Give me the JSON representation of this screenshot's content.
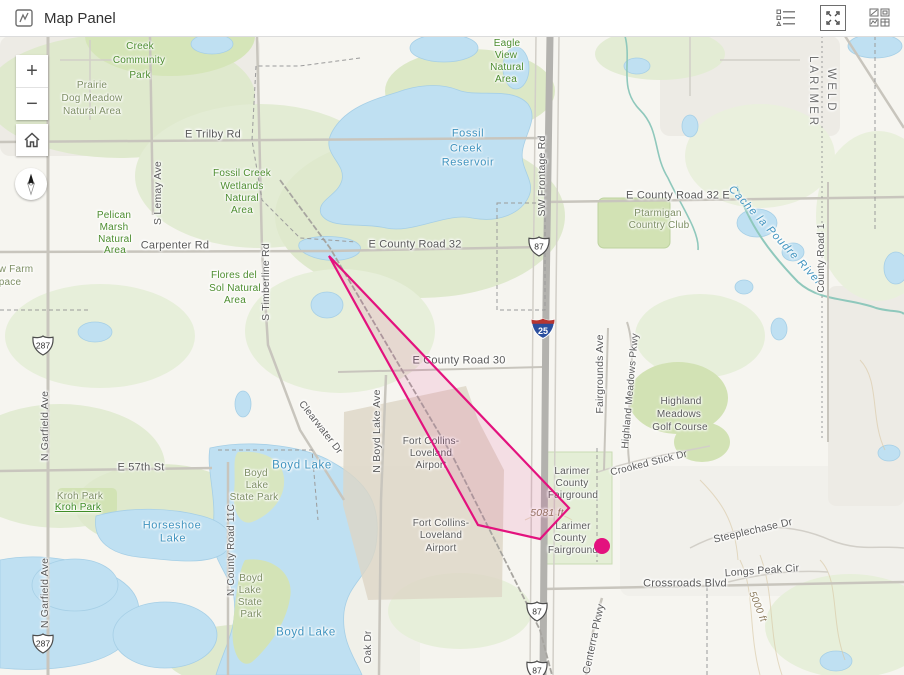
{
  "header": {
    "title": "Map Panel",
    "icons": {
      "left": "map-panel-icon",
      "right": [
        "legend-icon",
        "expand-icon",
        "grid-icon"
      ]
    }
  },
  "controls": {
    "zoom_in": "+",
    "zoom_out": "−",
    "home": "home-icon",
    "compass": "compass-north-icon"
  },
  "colors": {
    "accent_magenta": "#e3127e",
    "water_fill": "#bfe0f2",
    "veg_green": "#dfe9cd",
    "highway_gray": "#b3b2ae"
  },
  "map": {
    "overlay": {
      "polygon": {
        "points": [
          [
            329,
            220
          ],
          [
            569,
            472
          ],
          [
            540,
            503
          ],
          [
            478,
            489
          ]
        ],
        "stroke": "#e3127e",
        "fill": "rgba(227,18,126,0.10)"
      },
      "point": {
        "x": 602,
        "y": 510,
        "r": 8,
        "color": "#e3127e"
      }
    },
    "shields": [
      {
        "t": "287",
        "k": "us",
        "x": 43,
        "y": 312
      },
      {
        "t": "287",
        "k": "us",
        "x": 43,
        "y": 610
      },
      {
        "t": "87",
        "k": "us",
        "x": 539,
        "y": 213
      },
      {
        "t": "87",
        "k": "us",
        "x": 537,
        "y": 578
      },
      {
        "t": "87",
        "k": "us",
        "x": 537,
        "y": 637
      },
      {
        "t": "25",
        "k": "i",
        "x": 543,
        "y": 295
      }
    ],
    "labels": [
      {
        "t": "Creek",
        "x": 140,
        "y": 11,
        "c": "park"
      },
      {
        "t": "Community",
        "x": 139,
        "y": 25,
        "c": "park"
      },
      {
        "t": "Park",
        "x": 140,
        "y": 40,
        "c": "park"
      },
      {
        "t": "Eagle",
        "x": 507,
        "y": 8,
        "c": "park"
      },
      {
        "t": "View",
        "x": 506,
        "y": 20,
        "c": "park"
      },
      {
        "t": "Natural",
        "x": 507,
        "y": 32,
        "c": "park"
      },
      {
        "t": "Area",
        "x": 506,
        "y": 44,
        "c": "park"
      },
      {
        "t": "Fossil Creek",
        "x": 242,
        "y": 138,
        "c": "park"
      },
      {
        "t": "Wetlands",
        "x": 242,
        "y": 151,
        "c": "park"
      },
      {
        "t": "Natural",
        "x": 242,
        "y": 163,
        "c": "park"
      },
      {
        "t": "Area",
        "x": 242,
        "y": 175,
        "c": "park"
      },
      {
        "t": "Pelican",
        "x": 114,
        "y": 180,
        "c": "park"
      },
      {
        "t": "Marsh",
        "x": 114,
        "y": 192,
        "c": "park"
      },
      {
        "t": "Natural",
        "x": 115,
        "y": 204,
        "c": "park"
      },
      {
        "t": "Area",
        "x": 115,
        "y": 215,
        "c": "park"
      },
      {
        "t": "Flores del",
        "x": 234,
        "y": 240,
        "c": "park"
      },
      {
        "t": "Sol Natural",
        "x": 235,
        "y": 253,
        "c": "park"
      },
      {
        "t": "Area",
        "x": 235,
        "y": 265,
        "c": "park"
      },
      {
        "t": "Prairie",
        "x": 92,
        "y": 50,
        "c": "natural"
      },
      {
        "t": "Dog Meadow",
        "x": 92,
        "y": 63,
        "c": "natural"
      },
      {
        "t": "Natural Area",
        "x": 92,
        "y": 76,
        "c": "natural"
      },
      {
        "t": "w Farm",
        "x": 16,
        "y": 234,
        "c": "natural"
      },
      {
        "t": "pace",
        "x": 10,
        "y": 247,
        "c": "natural"
      },
      {
        "t": "Ptarmigan",
        "x": 658,
        "y": 178,
        "c": "natural"
      },
      {
        "t": "Country Club",
        "x": 659,
        "y": 190,
        "c": "natural"
      },
      {
        "t": "Kroh Park",
        "x": 80,
        "y": 461,
        "c": "natural"
      },
      {
        "t": "Kroh Park",
        "x": 78,
        "y": 472,
        "c": "link"
      },
      {
        "t": "Boyd",
        "x": 256,
        "y": 438,
        "c": "natural"
      },
      {
        "t": "Lake",
        "x": 257,
        "y": 450,
        "c": "natural"
      },
      {
        "t": "State Park",
        "x": 254,
        "y": 462,
        "c": "natural"
      },
      {
        "t": "Boyd",
        "x": 251,
        "y": 543,
        "c": "natural"
      },
      {
        "t": "Lake",
        "x": 250,
        "y": 555,
        "c": "natural"
      },
      {
        "t": "State",
        "x": 250,
        "y": 567,
        "c": "natural"
      },
      {
        "t": "Park",
        "x": 251,
        "y": 579,
        "c": "natural"
      },
      {
        "t": "Fossil",
        "x": 468,
        "y": 98,
        "c": "water",
        "s": 11
      },
      {
        "t": "Creek",
        "x": 466,
        "y": 113,
        "c": "water",
        "s": 11
      },
      {
        "t": "Reservoir",
        "x": 468,
        "y": 127,
        "c": "water",
        "s": 11
      },
      {
        "t": "Horseshoe",
        "x": 172,
        "y": 490,
        "c": "water",
        "s": 11
      },
      {
        "t": "Lake",
        "x": 173,
        "y": 503,
        "c": "water",
        "s": 11
      },
      {
        "t": "Boyd Lake",
        "x": 302,
        "y": 430,
        "c": "water",
        "s": 11.5
      },
      {
        "t": "Boyd Lake",
        "x": 306,
        "y": 597,
        "c": "water",
        "s": 11.5
      },
      {
        "t": "Cache la Poudre River",
        "x": 775,
        "y": 200,
        "c": "river",
        "s": 11,
        "r": 47
      },
      {
        "t": "E Trilby Rd",
        "x": 213,
        "y": 99,
        "c": "road",
        "s": 11
      },
      {
        "t": "Carpenter Rd",
        "x": 175,
        "y": 210,
        "c": "road",
        "s": 11
      },
      {
        "t": "E County Road 32",
        "x": 415,
        "y": 209,
        "c": "road",
        "s": 11
      },
      {
        "t": "E County Road 32 E",
        "x": 678,
        "y": 160,
        "c": "road",
        "s": 11
      },
      {
        "t": "E County Road 30",
        "x": 459,
        "y": 325,
        "c": "road",
        "s": 11
      },
      {
        "t": "E 57th St",
        "x": 141,
        "y": 432,
        "c": "road",
        "s": 11
      },
      {
        "t": "Crossroads Blvd",
        "x": 685,
        "y": 548,
        "c": "road",
        "s": 11
      },
      {
        "t": "Longs Peak Cir",
        "x": 762,
        "y": 535,
        "c": "road",
        "s": 10.5,
        "r": -4
      },
      {
        "t": "Steeplechase Dr",
        "x": 753,
        "y": 495,
        "c": "road",
        "s": 10.5,
        "r": -13
      },
      {
        "t": "Crooked Stick Dr",
        "x": 649,
        "y": 428,
        "c": "road",
        "s": 10,
        "r": -14
      },
      {
        "t": "Clearwater Dr",
        "x": 320,
        "y": 392,
        "c": "road",
        "s": 10,
        "r": 52
      },
      {
        "t": "S Lemay Ave",
        "x": 158,
        "y": 157,
        "c": "road",
        "s": 10.5,
        "r": -90
      },
      {
        "t": "S Timberline Rd",
        "x": 266,
        "y": 246,
        "c": "road",
        "s": 10.5,
        "r": -90
      },
      {
        "t": "SW Frontage Rd",
        "x": 542,
        "y": 140,
        "c": "road",
        "s": 10.5,
        "r": -90
      },
      {
        "t": "N Boyd Lake Ave",
        "x": 377,
        "y": 395,
        "c": "road",
        "s": 10.5,
        "r": -90
      },
      {
        "t": "Fairgrounds Ave",
        "x": 600,
        "y": 338,
        "c": "road",
        "s": 10.5,
        "r": -90
      },
      {
        "t": "Highland Meadows Pkwy",
        "x": 631,
        "y": 355,
        "c": "road",
        "s": 10,
        "r": -85
      },
      {
        "t": "County Road 1",
        "x": 822,
        "y": 222,
        "c": "road",
        "s": 10,
        "r": -90
      },
      {
        "t": "N County Road 11C",
        "x": 232,
        "y": 514,
        "c": "road",
        "s": 10,
        "r": -90
      },
      {
        "t": "N Garfield Ave",
        "x": 45,
        "y": 390,
        "c": "road",
        "s": 10.5,
        "r": -90
      },
      {
        "t": "N Garfield Ave",
        "x": 45,
        "y": 557,
        "c": "road",
        "s": 10.5,
        "r": -90
      },
      {
        "t": "Centerra Pkwy",
        "x": 594,
        "y": 603,
        "c": "road",
        "s": 10.5,
        "r": -78
      },
      {
        "t": "Oak Dr",
        "x": 369,
        "y": 611,
        "c": "road",
        "s": 10,
        "r": -90
      },
      {
        "t": "Highland",
        "x": 681,
        "y": 366,
        "c": "road"
      },
      {
        "t": "Meadows",
        "x": 679,
        "y": 379,
        "c": "road"
      },
      {
        "t": "Golf Course",
        "x": 680,
        "y": 392,
        "c": "road"
      },
      {
        "t": "Larimer",
        "x": 572,
        "y": 436,
        "c": "road"
      },
      {
        "t": "County",
        "x": 572,
        "y": 448,
        "c": "road"
      },
      {
        "t": "Fairground",
        "x": 573,
        "y": 460,
        "c": "road"
      },
      {
        "t": "Larimer",
        "x": 573,
        "y": 491,
        "c": "road"
      },
      {
        "t": "County",
        "x": 570,
        "y": 503,
        "c": "road"
      },
      {
        "t": "Fairground",
        "x": 573,
        "y": 515,
        "c": "road"
      },
      {
        "t": "Fort Collins-",
        "x": 431,
        "y": 406,
        "c": "road"
      },
      {
        "t": "Loveland",
        "x": 431,
        "y": 418,
        "c": "road"
      },
      {
        "t": "Airport",
        "x": 431,
        "y": 430,
        "c": "road"
      },
      {
        "t": "Fort Collins-",
        "x": 441,
        "y": 488,
        "c": "road"
      },
      {
        "t": "Loveland",
        "x": 441,
        "y": 500,
        "c": "road"
      },
      {
        "t": "Airport",
        "x": 441,
        "y": 513,
        "c": "road"
      },
      {
        "t": "LARIMER",
        "x": 812,
        "y": 56,
        "c": "county",
        "s": 11.5,
        "r": 90
      },
      {
        "t": "WELD",
        "x": 830,
        "y": 55,
        "c": "county",
        "s": 11.5,
        "r": 90
      },
      {
        "t": "5081 ft",
        "x": 547,
        "y": 477,
        "c": "contour",
        "s": 10.5
      },
      {
        "t": "5000 ft",
        "x": 757,
        "y": 571,
        "c": "contour",
        "s": 10,
        "r": 68
      }
    ]
  }
}
